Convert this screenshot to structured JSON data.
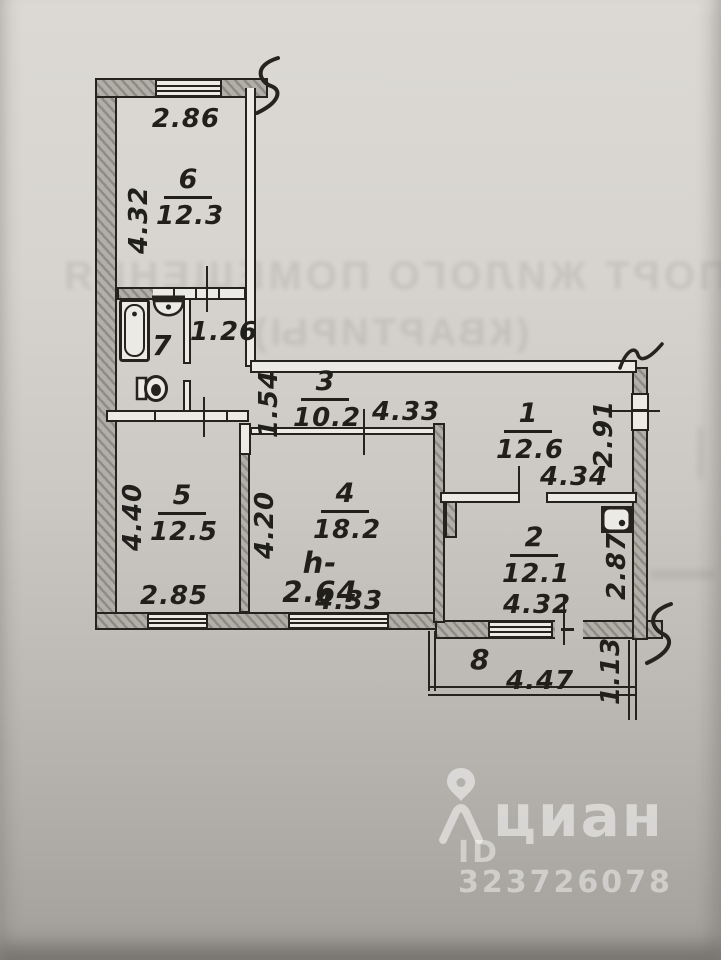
{
  "plan": {
    "ceiling_height": "h-2.64",
    "rooms": {
      "r1": {
        "num": "1",
        "area": "12.6",
        "width": "4.34",
        "height": "2.91"
      },
      "r2": {
        "num": "2",
        "area": "12.1",
        "width": "4.32",
        "height": "2.87"
      },
      "r3": {
        "num": "3",
        "area": "10.2",
        "width": "4.33",
        "height": "1.54"
      },
      "r4": {
        "num": "4",
        "area": "18.2",
        "width": "4.33",
        "height": "4.20"
      },
      "r5": {
        "num": "5",
        "area": "12.5",
        "width": "2.85",
        "height": "4.40"
      },
      "r6": {
        "num": "6",
        "area": "12.3",
        "width": "2.86",
        "height": "4.32"
      },
      "r7": {
        "num": "7"
      },
      "r8": {
        "num": "8",
        "width": "4.47",
        "height": "1.13"
      },
      "hall": {
        "width": "1.26"
      }
    }
  },
  "watermark": {
    "brand": "циан",
    "listing_id": "ID 323726078"
  },
  "bleed_through": {
    "line1": "ПАСПОРТ ЖИЛОГО ПОМЕЩЕНИЯ",
    "line2": "(КВАРТИРЫ)"
  },
  "colors": {
    "ink": "#26231e",
    "paper_top": "#dad7d2",
    "paper_bottom": "#a29f9a",
    "wall_fill": "#a39f99",
    "watermark_text": "rgba(255,255,255,0.5)"
  }
}
